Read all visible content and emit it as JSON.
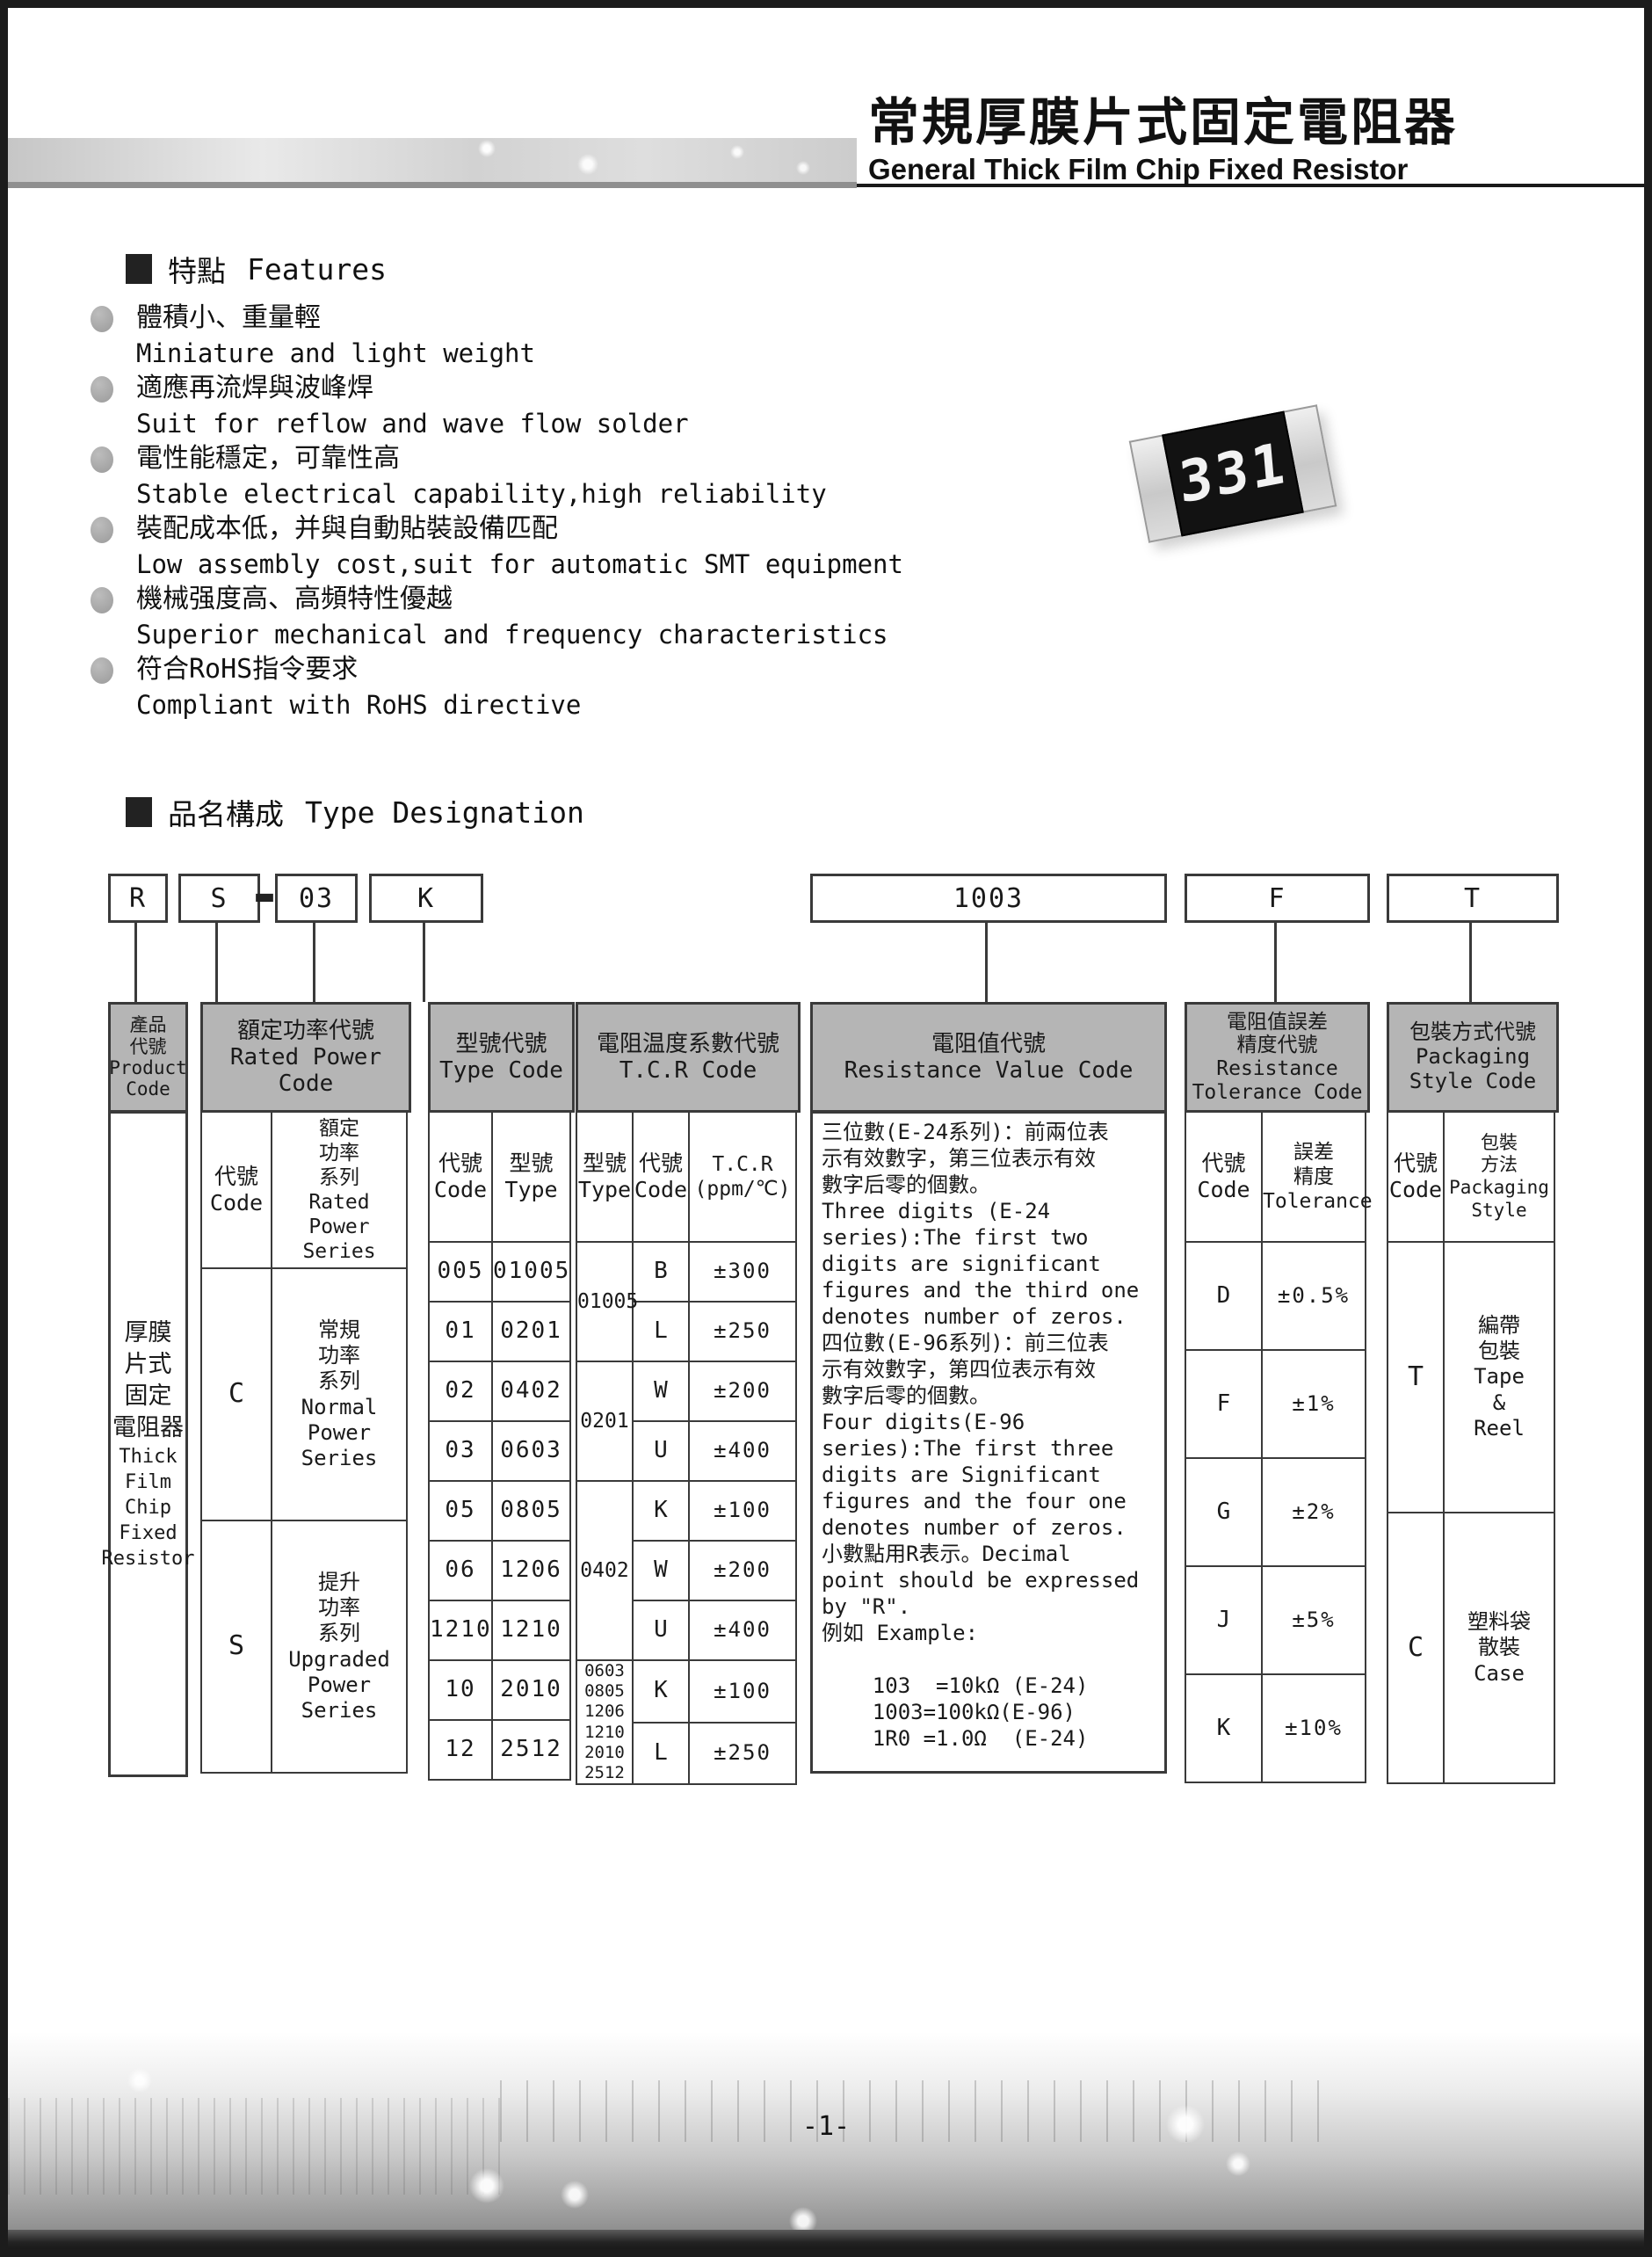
{
  "page": {
    "page_number": "-1-"
  },
  "header": {
    "title_cjk": "常規厚膜片式固定電阻器",
    "title_en": "General Thick Film Chip Fixed Resistor"
  },
  "resistor": {
    "marking": "331"
  },
  "features": {
    "title_cjk": "特點",
    "title_en": "Features",
    "items": [
      {
        "cjk": "體積小、重量輕",
        "en": "Miniature and light weight"
      },
      {
        "cjk": "適應再流焊與波峰焊",
        "en": "Suit for reflow and wave flow solder"
      },
      {
        "cjk": "電性能穩定，可靠性高",
        "en": "Stable electrical capability,high reliability"
      },
      {
        "cjk": "裝配成本低，并與自動貼裝設備匹配",
        "en": "Low assembly cost,suit for automatic SMT equipment"
      },
      {
        "cjk": "機械强度高、高頻特性優越",
        "en": "Superior mechanical and frequency characteristics"
      },
      {
        "cjk": "符合RoHS指令要求",
        "en": "Compliant with RoHS directive"
      }
    ]
  },
  "designation": {
    "title_cjk": "品名構成",
    "title_en": "Type Designation",
    "codes": {
      "product": "R",
      "power": "S",
      "dash": "-",
      "type": "03",
      "tcr": "K",
      "value": "1003",
      "tolerance": "F",
      "packaging": "T"
    },
    "product": {
      "head": [
        "產品",
        "代號",
        "Product",
        "Code"
      ],
      "body_cjk": [
        "厚膜",
        "片式",
        "固定",
        "電阻器"
      ],
      "body_en": [
        "Thick",
        "Film",
        "Chip",
        "Fixed",
        "Resistor"
      ]
    },
    "power": {
      "head": [
        "額定功率代號",
        "Rated Power",
        "Code"
      ],
      "sub_code": [
        "代號",
        "Code"
      ],
      "sub_series": [
        "額定",
        "功率",
        "系列",
        "Rated",
        "Power",
        "Series"
      ],
      "rows": [
        {
          "code": "C",
          "series": [
            "常規",
            "功率",
            "系列",
            "Normal",
            "Power",
            "Series"
          ]
        },
        {
          "code": "S",
          "series": [
            "提升",
            "功率",
            "系列",
            "Upgraded",
            "Power",
            "Series"
          ]
        }
      ]
    },
    "type": {
      "head": [
        "型號代號",
        "Type Code"
      ],
      "sub_code": [
        "代號",
        "Code"
      ],
      "sub_type": [
        "型號",
        "Type"
      ],
      "rows": [
        [
          "005",
          "01005"
        ],
        [
          "01",
          "0201"
        ],
        [
          "02",
          "0402"
        ],
        [
          "03",
          "0603"
        ],
        [
          "05",
          "0805"
        ],
        [
          "06",
          "1206"
        ],
        [
          "1210",
          "1210"
        ],
        [
          "10",
          "2010"
        ],
        [
          "12",
          "2512"
        ]
      ]
    },
    "tcr": {
      "head": [
        "電阻温度系數代號",
        "T.C.R Code"
      ],
      "sub_type": [
        "型號",
        "Type"
      ],
      "sub_code": [
        "代號",
        "Code"
      ],
      "sub_tcr": [
        "T.C.R",
        "(ppm/℃)"
      ],
      "groups": [
        {
          "type": [
            "01005"
          ],
          "rows": [
            [
              "B",
              "±300"
            ],
            [
              "L",
              "±250"
            ]
          ]
        },
        {
          "type": [
            "0201"
          ],
          "rows": [
            [
              "W",
              "±200"
            ],
            [
              "U",
              "±400"
            ]
          ]
        },
        {
          "type": [
            "0402"
          ],
          "rows": [
            [
              "K",
              "±100"
            ],
            [
              "W",
              "±200"
            ],
            [
              "U",
              "±400"
            ]
          ]
        },
        {
          "type": [
            "0603",
            "0805",
            "1206",
            "1210",
            "2010",
            "2512"
          ],
          "rows": [
            [
              "K",
              "±100"
            ],
            [
              "L",
              "±250"
            ]
          ]
        }
      ]
    },
    "value": {
      "head": [
        "電阻值代號",
        "Resistance Value Code"
      ],
      "text": [
        "三位數(E-24系列)：前兩位表",
        "示有效數字，第三位表示有效",
        "數字后零的個數。",
        "Three digits (E-24",
        "series):The first two",
        "digits are significant",
        "figures and the third one",
        "denotes number of zeros.",
        "四位數(E-96系列)：前三位表",
        "示有效數字，第四位表示有效",
        "數字后零的個數。",
        "Four digits(E-96",
        "series):The first three",
        "digits are Significant",
        "figures and the four one",
        "denotes number of zeros.",
        "小數點用R表示。Decimal",
        "point should be expressed",
        "by \"R\".",
        "例如 Example:",
        "",
        "    103  =10kΩ (E-24)",
        "    1003=100kΩ(E-96)",
        "    1R0 =1.0Ω  (E-24)"
      ]
    },
    "tolerance": {
      "head": [
        "電阻值誤差",
        "精度代號",
        "Resistance",
        "Tolerance Code"
      ],
      "sub_code": [
        "代號",
        "Code"
      ],
      "sub_tol": [
        "誤差",
        "精度",
        "Tolerance"
      ],
      "rows": [
        [
          "D",
          "±0.5%"
        ],
        [
          "F",
          "±1%"
        ],
        [
          "G",
          "±2%"
        ],
        [
          "J",
          "±5%"
        ],
        [
          "K",
          "±10%"
        ]
      ]
    },
    "packaging": {
      "head": [
        "包裝方式代號",
        "Packaging",
        "Style Code"
      ],
      "sub_code": [
        "代號",
        "Code"
      ],
      "sub_style": [
        "包裝",
        "方法",
        "Packaging",
        "Style"
      ],
      "rows": [
        {
          "code": "T",
          "style": [
            "編帶",
            "包裝",
            "Tape",
            "&",
            "Reel"
          ]
        },
        {
          "code": "C",
          "style": [
            "塑料袋",
            "散裝",
            "Case"
          ]
        }
      ]
    }
  }
}
